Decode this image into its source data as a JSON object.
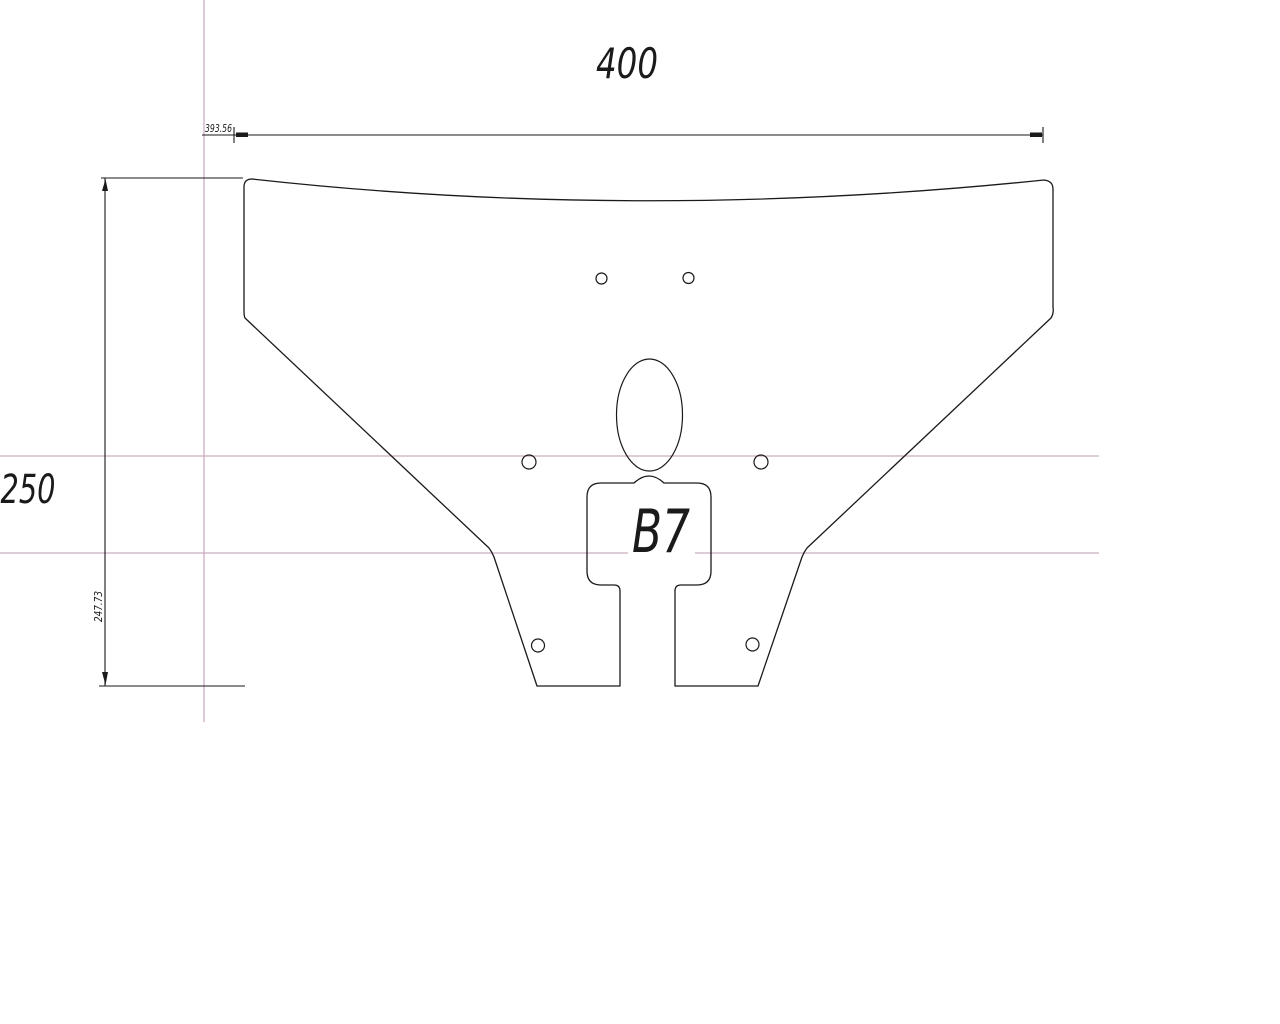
{
  "drawing": {
    "type": "cad-part-drawing",
    "part": {
      "label": "B7"
    },
    "dimensions": {
      "width_nominal": "400",
      "height_nominal": "250",
      "width_precise": "393.56",
      "height_precise": "247.73"
    },
    "colors": {
      "outline": "#1a1a1a",
      "dimension_lines": "#1a1a1a",
      "construction_lines": "#cbadc0",
      "background": "#ffffff"
    },
    "features": {
      "oval_hole": "center oval slot",
      "small_holes_count": 6,
      "legs_count": 2
    }
  }
}
